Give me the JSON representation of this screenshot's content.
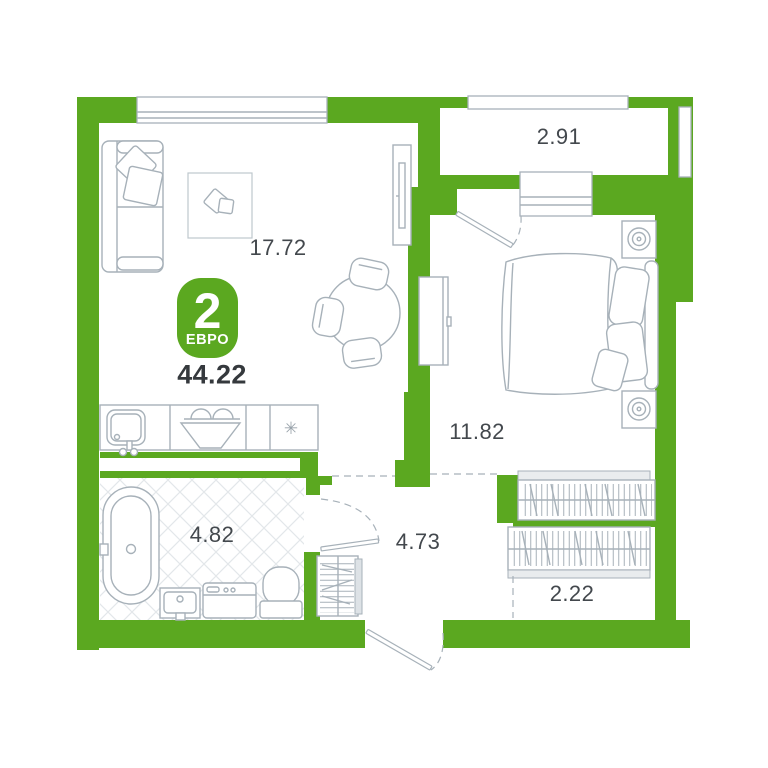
{
  "badge": {
    "rooms_count": "2",
    "type_label": "ЕВРО"
  },
  "total_area": "44.22",
  "rooms": {
    "living": {
      "area": "17.72"
    },
    "balcony": {
      "area": "2.91"
    },
    "bedroom": {
      "area": "11.82"
    },
    "bathroom": {
      "area": "4.82"
    },
    "hallway": {
      "area": "4.73"
    },
    "closet": {
      "area": "2.22"
    }
  },
  "symbols": {
    "fridge": "✳"
  },
  "colors": {
    "wall": "#5ba820",
    "line": "#a7b1b9",
    "line-light": "#bfc7cd",
    "tile": "#e3e7ea",
    "text": "#43484d",
    "text-strong": "#35393d",
    "badge-text": "#ffffff"
  }
}
